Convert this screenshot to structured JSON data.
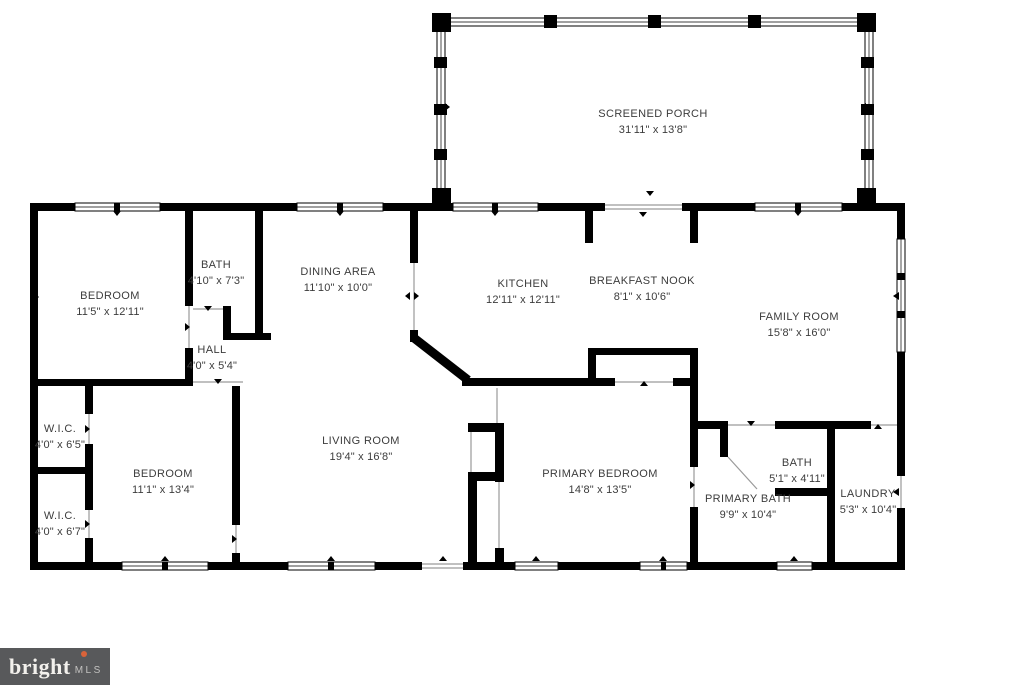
{
  "floor_plan": {
    "rooms": [
      {
        "name": "SCREENED PORCH",
        "dimensions": "31'11\" x 13'8\""
      },
      {
        "name": "BEDROOM",
        "dimensions": "11'5\" x 12'11\""
      },
      {
        "name": "BATH",
        "dimensions": "4'10\" x 7'3\""
      },
      {
        "name": "DINING AREA",
        "dimensions": "11'10\" x 10'0\""
      },
      {
        "name": "KITCHEN",
        "dimensions": "12'11\" x 12'11\""
      },
      {
        "name": "BREAKFAST NOOK",
        "dimensions": "8'1\" x 10'6\""
      },
      {
        "name": "FAMILY ROOM",
        "dimensions": "15'8\" x 16'0\""
      },
      {
        "name": "HALL",
        "dimensions": "4'0\" x 5'4\""
      },
      {
        "name": "W.I.C.",
        "dimensions": "4'0\" x 6'5\""
      },
      {
        "name": "BEDROOM",
        "dimensions": "11'1\" x 13'4\""
      },
      {
        "name": "W.I.C.",
        "dimensions": "4'0\" x 6'7\""
      },
      {
        "name": "LIVING ROOM",
        "dimensions": "19'4\" x 16'8\""
      },
      {
        "name": "PRIMARY BEDROOM",
        "dimensions": "14'8\" x 13'5\""
      },
      {
        "name": "PRIMARY BATH",
        "dimensions": "9'9\" x 10'4\""
      },
      {
        "name": "BATH",
        "dimensions": "5'1\" x 4'11\""
      },
      {
        "name": "LAUNDRY",
        "dimensions": "5'3\" x 10'4\""
      }
    ],
    "watermark": {
      "brand": "bright",
      "suffix": "MLS"
    },
    "colors": {
      "wall": "#000000",
      "background": "#ffffff",
      "label_text": "#3c3c3c",
      "door_line": "#9a9a9a",
      "logo_background": "#58595b",
      "logo_text": "#f2f0ec",
      "logo_accent": "#d9633a"
    }
  }
}
